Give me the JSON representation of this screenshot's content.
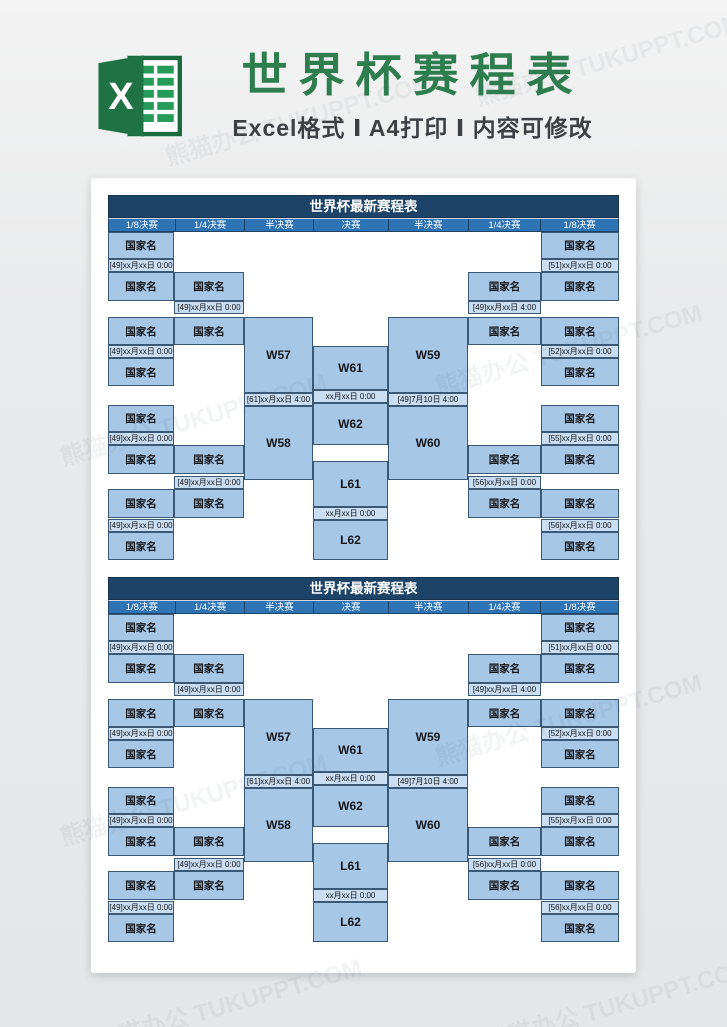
{
  "header": {
    "title": "世界杯赛程表",
    "subtitle": "Excel格式 Ⅰ A4打印 Ⅰ 内容可修改"
  },
  "watermark": {
    "text": "熊猫办公 TUKUPPT.COM"
  },
  "colors": {
    "accent_green": "#2e7d4f",
    "title_band": "#1d4368",
    "round_band": "#2e74b5",
    "team_cell": "#a7c7e7",
    "date_cell": "#c9def2",
    "page_background": "#e9eaeb"
  },
  "bracket": {
    "title": "世界杯最新赛程表",
    "columns": [
      "1/8决赛",
      "1/4决赛",
      "半决赛",
      "决赛",
      "半决赛",
      "1/4决赛",
      "1/8决赛"
    ],
    "team_placeholder": "国家名",
    "dates": {
      "d49_0": "[49]xx月xx日 0:00",
      "d49_4": "[49]xx月xx日 4:00",
      "d51": "[51]xx月xx日 0:00",
      "d52": "[52]xx月xx日 0:00",
      "d55": "[55]xx月xx日 0:00",
      "d56": "[56]xx月xx日 0:00",
      "d61": "[61]xx月xx日 4:00",
      "dsemi2": "[49]7月10日 4:00",
      "dfinal": "xx月xx日 0:00",
      "d3rd": "xx月xx日 0:00"
    },
    "matches": {
      "w57": "W57",
      "w58": "W58",
      "w59": "W59",
      "w60": "W60",
      "w61": "W61",
      "w62": "W62",
      "l61": "L61",
      "l62": "L62"
    }
  }
}
